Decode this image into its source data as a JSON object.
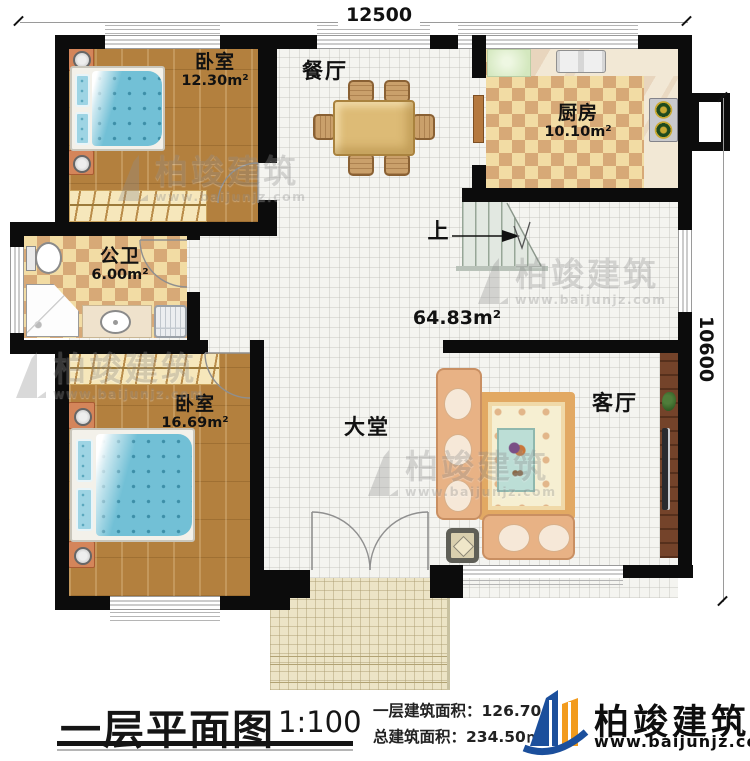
{
  "dimensions": {
    "top": "12500",
    "right": "10600"
  },
  "rooms": {
    "bedroom_top": {
      "name": "卧室",
      "area": "12.30m²"
    },
    "dining": {
      "name": "餐厅"
    },
    "kitchen": {
      "name": "厨房",
      "area": "10.10m²"
    },
    "bathroom": {
      "name": "公卫",
      "area": "6.00m²"
    },
    "bedroom_bottom": {
      "name": "卧室",
      "area": "16.69m²"
    },
    "hall": {
      "name": "大堂"
    },
    "living": {
      "name": "客厅"
    },
    "open_area": {
      "area": "64.83m²"
    },
    "stairs": {
      "direction": "上"
    }
  },
  "footer": {
    "title": "一层平面图",
    "scale": "1:100",
    "floor_area": "一层建筑面积：126.70㎡",
    "total_area": "总建筑面积：234.50㎡"
  },
  "brand": {
    "name": "柏竣建筑",
    "website": "www.baijunjz.com"
  },
  "watermark": {
    "name": "柏竣建筑",
    "website": "www.baijunjz.com"
  },
  "colors": {
    "wall": "#0c0c0c",
    "brand_blue": "#1b4f9c",
    "brand_orange": "#f29b1d"
  }
}
